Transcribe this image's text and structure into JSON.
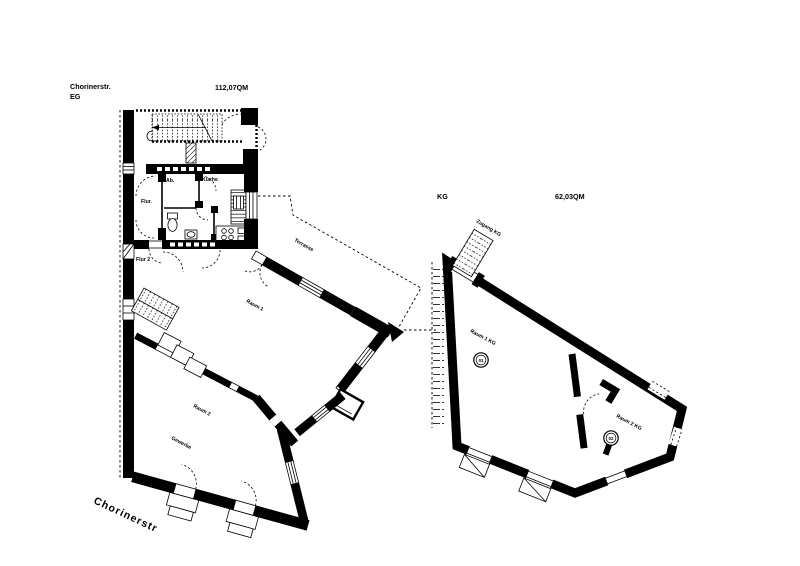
{
  "page": {
    "background": "#ffffff",
    "ink": "#000000"
  },
  "plans": {
    "eg": {
      "title_street": "Chorinerstr.",
      "title_floor": "EG",
      "area": "112,07QM",
      "rooms": {
        "flur": "Flur.",
        "ab": "Ab.",
        "kueche": "Küche",
        "flur2": "Flur 2",
        "raum1": "Raum 1",
        "terrasse": "Terrasse",
        "raum2": "Raum 2",
        "gewerbe": "Gewerbe"
      },
      "street_name": "Chorinerstr"
    },
    "kg": {
      "title_floor": "KG",
      "area": "62,03QM",
      "rooms": {
        "zugang": "Zugang KG",
        "raum1": "Raum 1 KG",
        "raum2": "Raum 2 KG"
      },
      "markers": {
        "m01": "01",
        "m02": "02"
      }
    }
  }
}
